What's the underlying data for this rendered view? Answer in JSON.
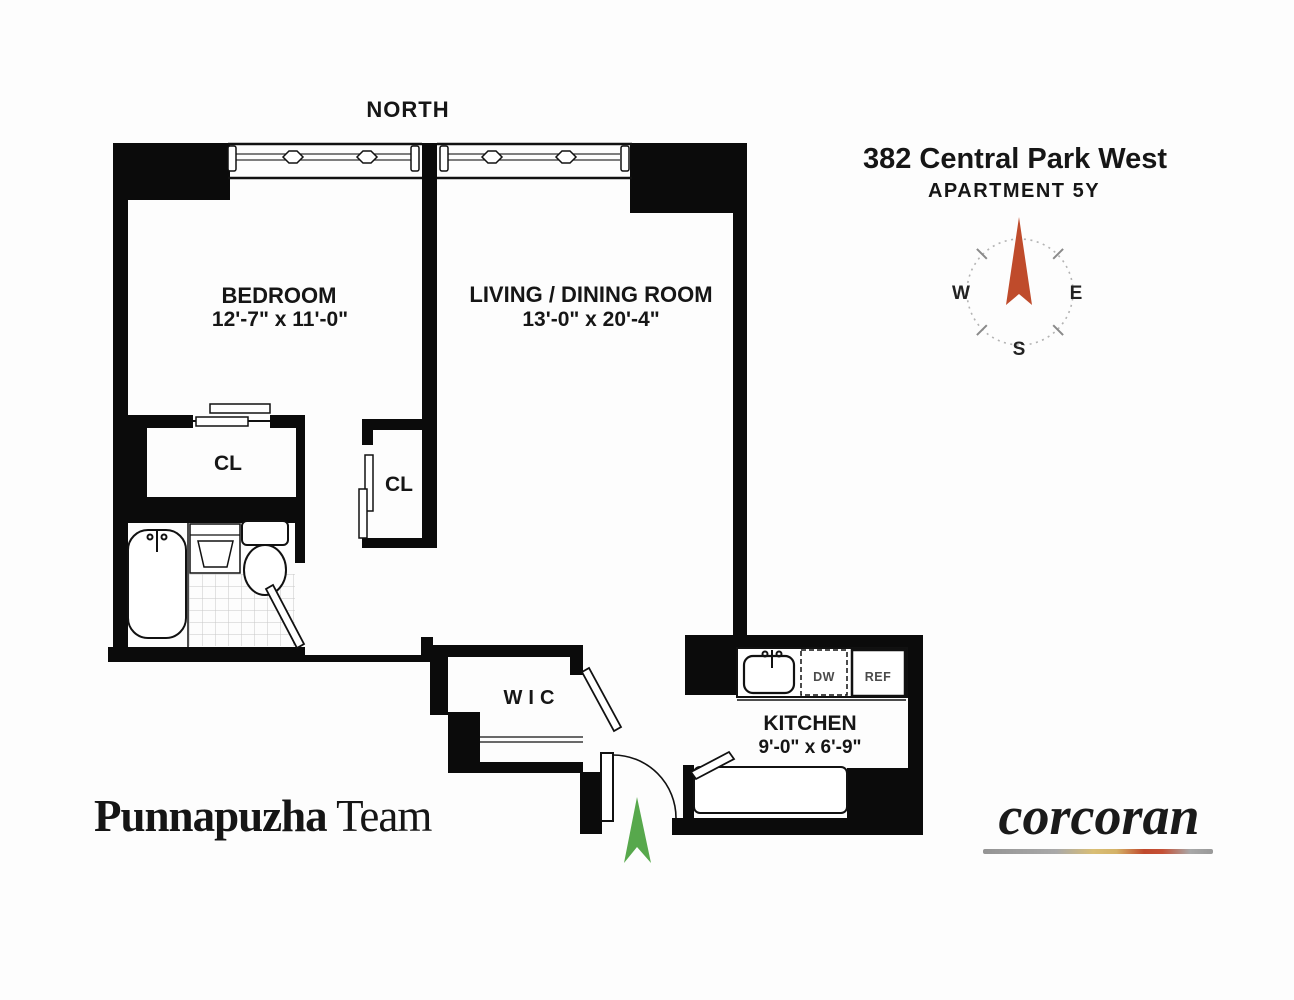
{
  "header": {
    "address": "382 Central Park West",
    "apartment": "APARTMENT 5Y"
  },
  "north_label": "NORTH",
  "compass": {
    "west": "W",
    "east": "E",
    "south": "S",
    "needle_color": "#bf4b2b"
  },
  "rooms": {
    "bedroom": {
      "name": "BEDROOM",
      "dims": "12'-7\" x 11'-0\""
    },
    "living_dining": {
      "name": "LIVING / DINING ROOM",
      "dims": "13'-0\" x 20'-4\""
    },
    "kitchen": {
      "name": "KITCHEN",
      "dims": "9'-0\" x 6'-9\""
    },
    "closet_bedroom": {
      "name": "CL"
    },
    "closet_hall": {
      "name": "CL"
    },
    "walk_in_closet": {
      "name": "WIC"
    }
  },
  "appliances": {
    "dishwasher": "DW",
    "refrigerator": "REF"
  },
  "entry": {
    "arrow_color": "#57a84c"
  },
  "branding": {
    "team_bold": "Punnapuzha",
    "team_regular": "Team",
    "brokerage": "corcoran",
    "gradient_colors": [
      "#969696",
      "#d9be75",
      "#c04a2d",
      "#999999"
    ]
  }
}
